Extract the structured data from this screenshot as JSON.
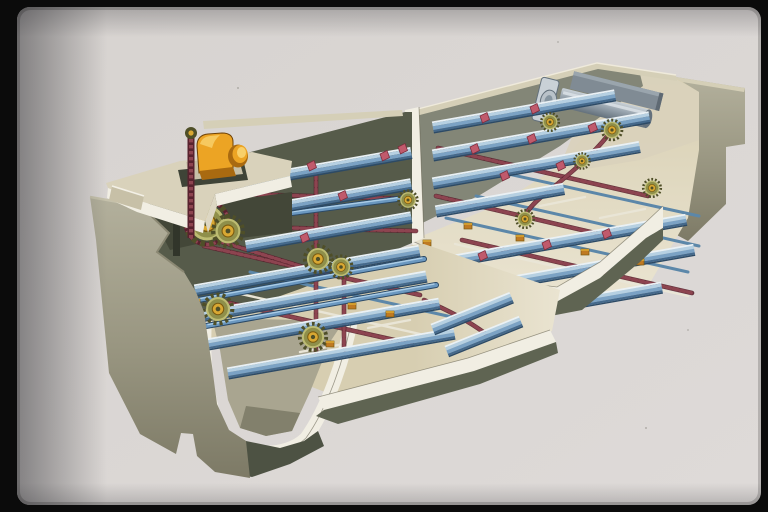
{
  "scene": {
    "kind": "technical-cutaway-illustration",
    "subject_components": [
      "slide-frame",
      "drive-motor",
      "drive-chain",
      "drive-sprocket",
      "walkway-deck",
      "effluent-launder-notch",
      "left-tank-bay",
      "right-tank-bay",
      "center-division-wall",
      "sludge-hopper",
      "collector-chain",
      "scraper-flight",
      "cross-shaft",
      "idler-sprocket",
      "chain-bracket",
      "bearing-block",
      "wear-rail",
      "scum-pipe",
      "scum-baffle",
      "concrete-wall",
      "floor-slab"
    ]
  },
  "colors": {
    "frame": "#0b0b0b",
    "slide1": "#d7d3d0",
    "slide2": "#dedad8",
    "cut": "#f1eee3",
    "cut2": "#ddd7c3",
    "deck": "#d9d2bb",
    "deckShade": "#c7c0a7",
    "conc1": "#b3b09c",
    "conc2": "#989580",
    "conc3": "#7d7a66",
    "interior": "#565b4a",
    "surfR": "#838677",
    "floor1": "#d7ceb1",
    "floor2": "#eae4d1",
    "front": "#5f6452",
    "front2": "#4d5243",
    "rim": "#d5cfb7",
    "rail": "#e9e5d6",
    "railBlue": "#5c87a9",
    "fl1": "#eaf1f5",
    "fl2": "#b6d0e2",
    "fl3": "#7ba2c4",
    "fl4": "#44698c",
    "fl5": "#2c4a66",
    "shaft": "#6b98c0",
    "shaftHi": "#aacce6",
    "chain": "#8d4450",
    "chainD": "#58222e",
    "pink": "#c05a6c",
    "pinkD": "#7c2d3c",
    "spr1": "#8f8f4a",
    "spr2": "#bdbc72",
    "spr3": "#4f4f28",
    "hub": "#d9a833",
    "hubD": "#7a5a10",
    "oblock": "#bf7a22",
    "motor": "#eca424",
    "motorHi": "#f8d06a",
    "motorD": "#a96a10",
    "pipe1": "#c9d1d7",
    "pipe2": "#97a3ad",
    "pipe3": "#64717c",
    "baffle": "#808b94",
    "underdeck": "#434738",
    "hopperIn": "#a9a590",
    "hopperShadow": "#82806c",
    "outline": "#55523f"
  }
}
